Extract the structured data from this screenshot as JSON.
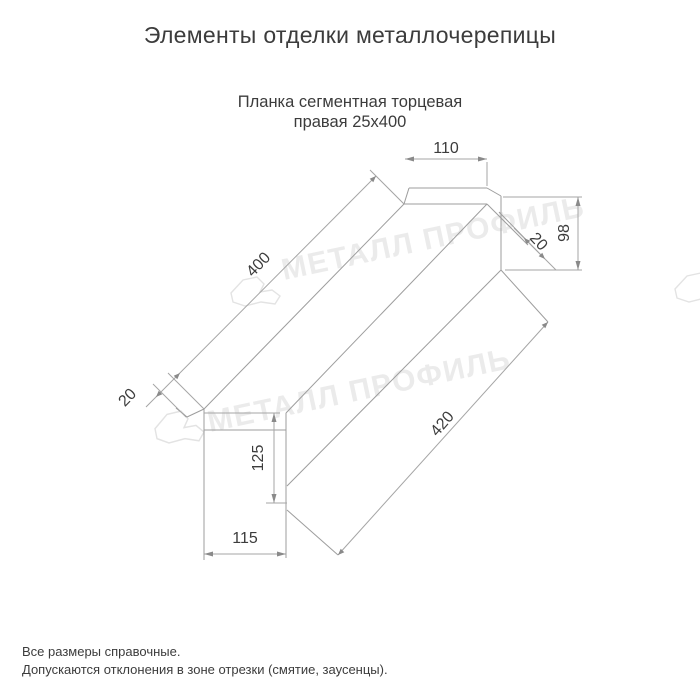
{
  "page": {
    "title": "Элементы отделки металлочерепицы",
    "footnote1": "Все размеры справочные.",
    "footnote2": "Допускаются отклонения в зоне отрезки (смятие, заусенцы)."
  },
  "product": {
    "title_line1": "Планка сегментная торцевая",
    "title_line2": "правая 25x400"
  },
  "drawing": {
    "dims": {
      "top_flange_width": "110",
      "far_end_height": "98",
      "far_hem": "20",
      "length_top": "400",
      "length_bottom": "420",
      "near_hem": "20",
      "front_height": "125",
      "bottom_width": "115"
    }
  },
  "watermark": {
    "text": "МЕТАЛЛ ПРОФИЛЬ"
  },
  "colors": {
    "line": "#9d9d9d",
    "text": "#3c3c3c",
    "watermark": "#ebebeb"
  }
}
